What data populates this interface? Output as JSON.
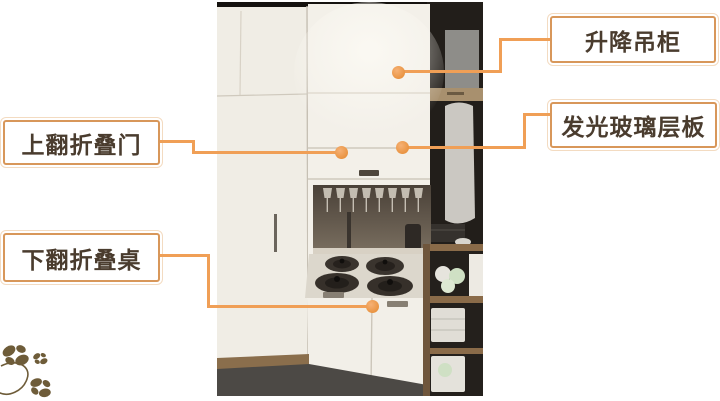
{
  "diagram": {
    "type": "annotated-furniture-photo",
    "background": "#FFFFFF",
    "accent_border_color": "#D8975A",
    "callout_line_color": "#F09F56",
    "label_text_color": "#4A3C2E",
    "labels": [
      {
        "id": "lifting-wall-cabinet",
        "text": "升降吊柜",
        "side": "right"
      },
      {
        "id": "luminous-glass-shelf",
        "text": "发光玻璃层板",
        "side": "right"
      },
      {
        "id": "fold-up-door",
        "text": "上翻折叠门",
        "side": "left"
      },
      {
        "id": "fold-down-table",
        "text": "下翻折叠桌",
        "side": "left"
      }
    ],
    "decoration": {
      "name": "butterfly-flower-ornament",
      "color": "#6E5C39",
      "position": "bottom-left"
    }
  }
}
